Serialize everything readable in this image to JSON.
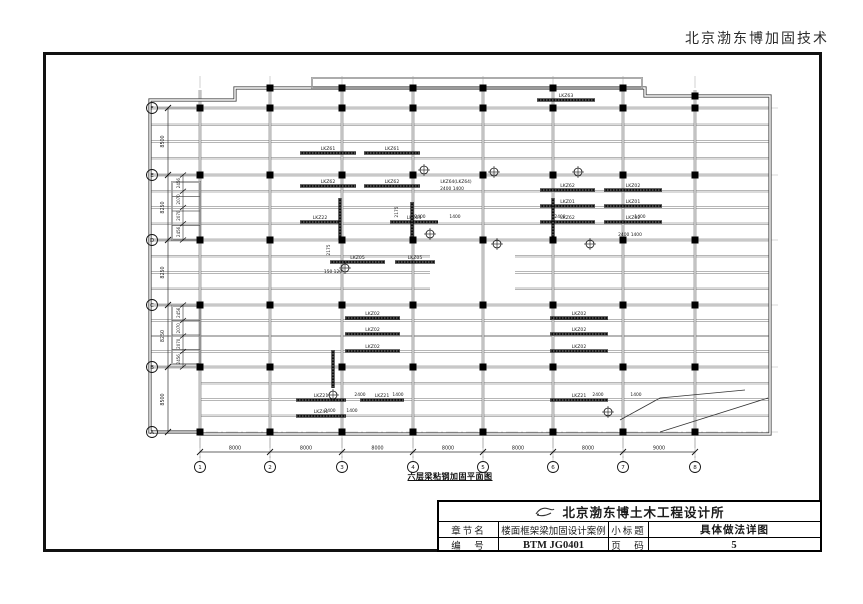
{
  "page": {
    "header_right": "北京渤东博加固技术"
  },
  "title_block": {
    "logo_icon": "sketch-bird-logo",
    "company": "北京渤东博土木工程设计所",
    "row_chapter": {
      "label": "章节名",
      "value": "楼面框架梁加固设计案例",
      "label2": "小标题",
      "value2": "具体做法详图"
    },
    "row_number": {
      "label": "编　号",
      "value": "BTM JG0401",
      "label2": "页　码",
      "value2": "5"
    }
  },
  "drawing": {
    "caption": "六层梁粘钢加固平面图",
    "grid_cols": [
      {
        "label": "1",
        "x": 200
      },
      {
        "label": "2",
        "x": 270
      },
      {
        "label": "3",
        "x": 342
      },
      {
        "label": "4",
        "x": 413
      },
      {
        "label": "5",
        "x": 483
      },
      {
        "label": "6",
        "x": 553
      },
      {
        "label": "7",
        "x": 623
      },
      {
        "label": "8",
        "x": 695
      }
    ],
    "col_dims": [
      "8000",
      "8000",
      "8000",
      "8000",
      "8000",
      "8000",
      "9000"
    ],
    "grid_rows": [
      {
        "label": "F",
        "y": 108
      },
      {
        "label": "E",
        "y": 175
      },
      {
        "label": "D",
        "y": 240
      },
      {
        "label": "C",
        "y": 305
      },
      {
        "label": "B",
        "y": 367
      },
      {
        "label": "A",
        "y": 432
      }
    ],
    "row_dims": [
      "8500",
      "8250",
      "8250",
      "8250",
      "8500"
    ],
    "sub_dims": [
      "2456",
      "2070",
      "2070",
      "2456"
    ],
    "outline": "M 235,88 L 645,88 L 645,96 L 770,96 L 770,434 L 200,434 L 200,432 L 150,432 L 150,100 L 235,100 Z",
    "bands": [
      {
        "y1": 108,
        "y2": 175,
        "lines": 3,
        "segs": [
          [
            150,
            770
          ]
        ]
      },
      {
        "y1": 175,
        "y2": 240,
        "lines": 3,
        "segs": [
          [
            150,
            770
          ]
        ]
      },
      {
        "y1": 240,
        "y2": 305,
        "lines": 3,
        "segs": [
          [
            150,
            430
          ],
          [
            515,
            770
          ]
        ]
      },
      {
        "y1": 305,
        "y2": 367,
        "lines": 3,
        "segs": [
          [
            150,
            770
          ]
        ]
      },
      {
        "y1": 367,
        "y2": 432,
        "lines": 3,
        "segs": [
          [
            200,
            770
          ]
        ]
      }
    ],
    "protrusions": [
      {
        "x": 172,
        "y": 182,
        "w": 28,
        "h": 58,
        "inner": 3
      },
      {
        "x": 172,
        "y": 306,
        "w": 28,
        "h": 58,
        "inner": 3
      },
      {
        "x": 312,
        "y": 78,
        "w": 330,
        "h": 10,
        "inner": 0
      }
    ],
    "bars": [
      {
        "x": 300,
        "y": 153,
        "w": 56,
        "label": "LKZ61"
      },
      {
        "x": 364,
        "y": 153,
        "w": 56,
        "label": "LKZ61"
      },
      {
        "x": 537,
        "y": 100,
        "w": 58,
        "label": "LKZ63"
      },
      {
        "x": 300,
        "y": 186,
        "w": 56,
        "label": "LKZ62"
      },
      {
        "x": 364,
        "y": 186,
        "w": 56,
        "label": "LKZ62"
      },
      {
        "x": 540,
        "y": 190,
        "w": 55,
        "label": "LKZ62"
      },
      {
        "x": 604,
        "y": 190,
        "w": 58,
        "label": "LKZ02"
      },
      {
        "x": 540,
        "y": 206,
        "w": 55,
        "label": "LKZ01"
      },
      {
        "x": 604,
        "y": 206,
        "w": 58,
        "label": "LKZ01"
      },
      {
        "x": 300,
        "y": 222,
        "w": 40,
        "label": "LKZ22"
      },
      {
        "x": 390,
        "y": 222,
        "w": 48,
        "label": "LKZ64"
      },
      {
        "x": 540,
        "y": 222,
        "w": 55,
        "label": "LKZ62"
      },
      {
        "x": 604,
        "y": 222,
        "w": 58,
        "label": "LKZ02"
      },
      {
        "x": 330,
        "y": 262,
        "w": 55,
        "label": "LKZ05"
      },
      {
        "x": 395,
        "y": 262,
        "w": 40,
        "label": "LKZ05"
      },
      {
        "x": 345,
        "y": 318,
        "w": 55,
        "label": "LKZ02"
      },
      {
        "x": 550,
        "y": 318,
        "w": 58,
        "label": "LKZ02"
      },
      {
        "x": 345,
        "y": 334,
        "w": 55,
        "label": "LKZ02"
      },
      {
        "x": 550,
        "y": 334,
        "w": 58,
        "label": "LKZ02"
      },
      {
        "x": 345,
        "y": 351,
        "w": 55,
        "label": "LKZ02"
      },
      {
        "x": 550,
        "y": 351,
        "w": 58,
        "label": "LKZ02"
      },
      {
        "x": 296,
        "y": 400,
        "w": 50,
        "label": "LKZ21"
      },
      {
        "x": 360,
        "y": 400,
        "w": 44,
        "label": "LKZ21"
      },
      {
        "x": 550,
        "y": 400,
        "w": 58,
        "label": "LKZ21"
      },
      {
        "x": 296,
        "y": 416,
        "w": 50,
        "label": "LKZ41"
      }
    ],
    "vbars": [
      {
        "x": 340,
        "y1": 198,
        "y2": 240
      },
      {
        "x": 412,
        "y1": 202,
        "y2": 240
      },
      {
        "x": 553,
        "y1": 198,
        "y2": 240
      },
      {
        "x": 333,
        "y1": 350,
        "y2": 388
      }
    ],
    "columns_extra": [
      [
        270,
        88
      ],
      [
        342,
        88
      ],
      [
        413,
        88
      ],
      [
        483,
        88
      ],
      [
        553,
        88
      ],
      [
        623,
        88
      ],
      [
        695,
        96
      ]
    ],
    "dim_texts": [
      {
        "t": "LKZ64(LKZ64)",
        "x": 456,
        "y": 183
      },
      {
        "t": "2400  1400",
        "x": 452,
        "y": 190
      },
      {
        "t": "2400  1400",
        "x": 630,
        "y": 236
      },
      {
        "t": "2400",
        "x": 420,
        "y": 218
      },
      {
        "t": "1400",
        "x": 455,
        "y": 218
      },
      {
        "t": "2400",
        "x": 560,
        "y": 218
      },
      {
        "t": "1400",
        "x": 640,
        "y": 218
      },
      {
        "t": "2175",
        "x": 398,
        "y": 212,
        "rot": true
      },
      {
        "t": "2175",
        "x": 330,
        "y": 250,
        "rot": true
      },
      {
        "t": "150 120",
        "x": 333,
        "y": 273
      },
      {
        "t": "2400",
        "x": 360,
        "y": 396
      },
      {
        "t": "1400",
        "x": 398,
        "y": 396
      },
      {
        "t": "2400",
        "x": 598,
        "y": 396
      },
      {
        "t": "1400",
        "x": 636,
        "y": 396
      },
      {
        "t": "2400",
        "x": 330,
        "y": 412
      },
      {
        "t": "1400",
        "x": 352,
        "y": 412
      }
    ],
    "targets": [
      [
        424,
        170
      ],
      [
        494,
        172
      ],
      [
        578,
        172
      ],
      [
        430,
        234
      ],
      [
        497,
        244
      ],
      [
        590,
        244
      ],
      [
        345,
        268
      ],
      [
        608,
        412
      ],
      [
        333,
        395
      ]
    ],
    "leaders": [
      "620,420 660,398 745,390",
      "660,432 768,398"
    ]
  }
}
